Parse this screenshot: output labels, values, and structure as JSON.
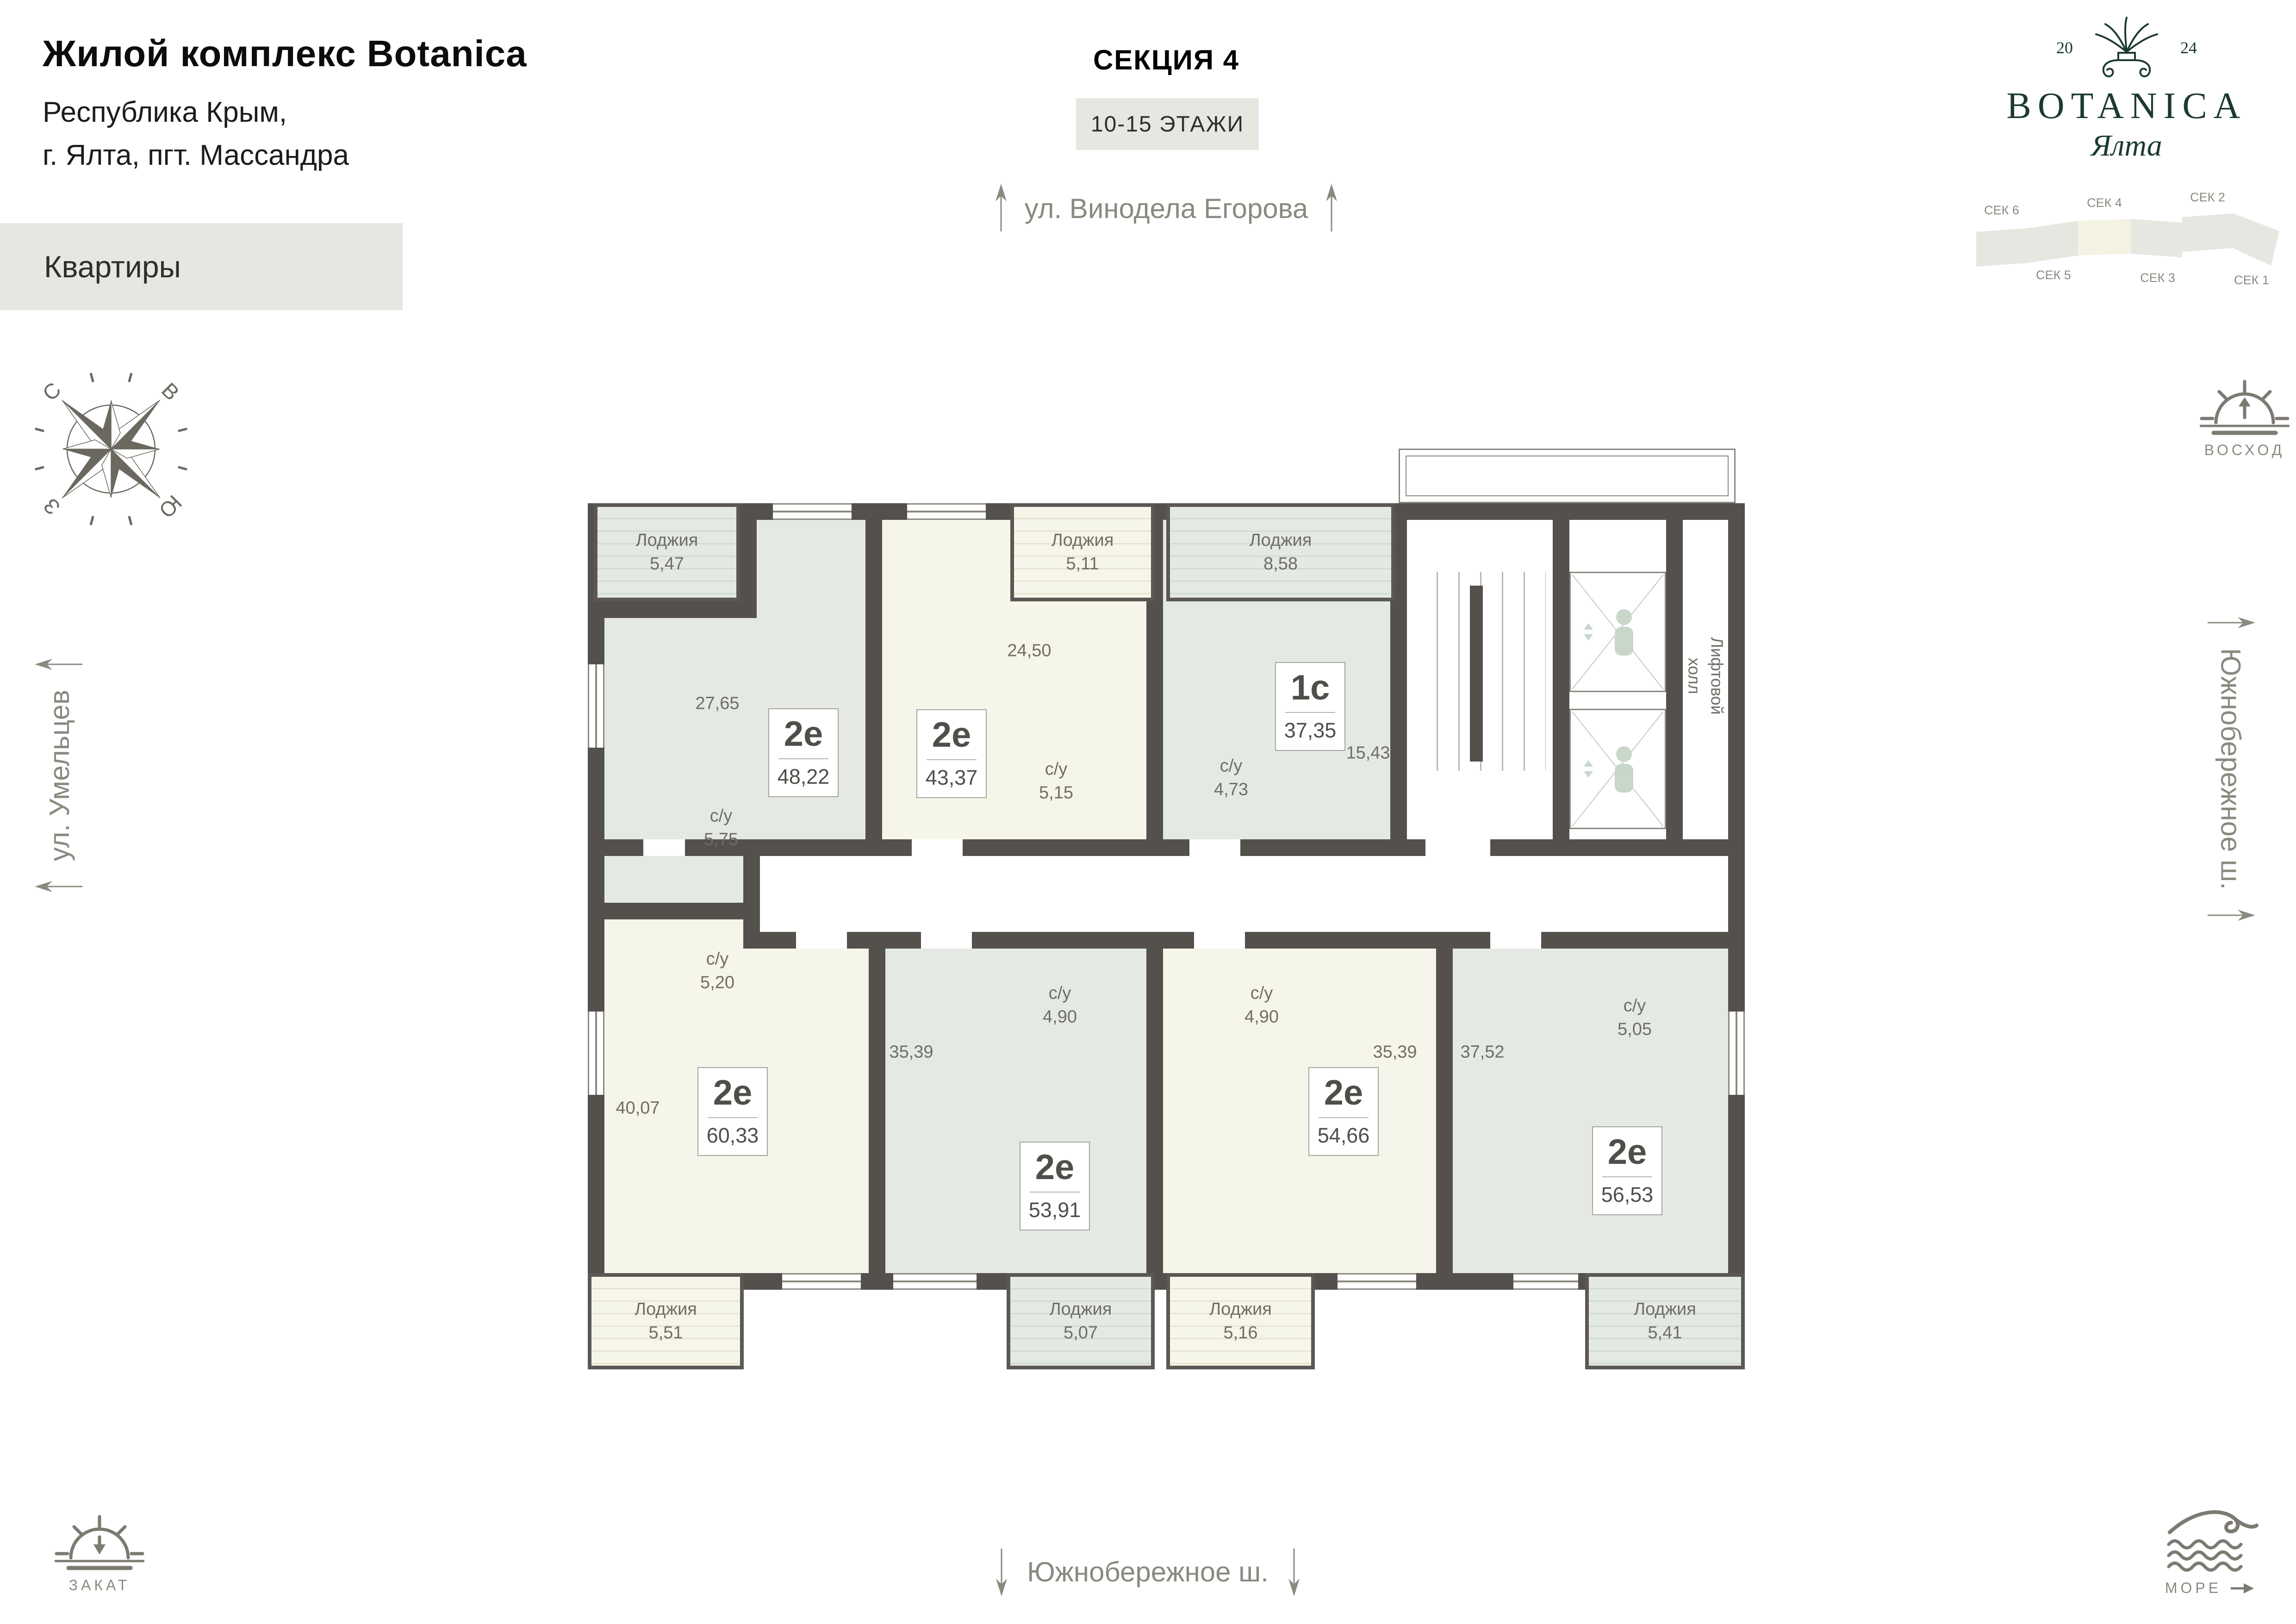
{
  "header": {
    "title": "Жилой комплекс Botanica",
    "address1": "Республика Крым,",
    "address2": "г. Ялта, пгт. Массандра",
    "category": "Квартиры"
  },
  "section": {
    "name": "СЕКЦИЯ 4",
    "floors": "10-15 ЭТАЖИ"
  },
  "streets": {
    "top": "ул. Винодела Егорова",
    "left": "ул. Умельцев",
    "right": "Южнобережное ш.",
    "bottom": "Южнобережное ш."
  },
  "logo": {
    "year_left": "20",
    "year_right": "24",
    "brand": "BOTANICA",
    "city": "Ялта"
  },
  "section_map": {
    "labels": [
      "СЕК 6",
      "СЕК 4",
      "СЕК 2",
      "СЕК 5",
      "СЕК 3",
      "СЕК 1"
    ],
    "highlight": "СЕК 4"
  },
  "compass": {
    "n": "С",
    "e": "В",
    "w": "З",
    "s": "Ю"
  },
  "landmarks": {
    "sunrise": "ВОСХОД",
    "sunset": "ЗАКАТ",
    "sea": "МОРЕ"
  },
  "colors": {
    "accent": "#1c3a31",
    "wall": "#54514d",
    "green_room": "#e4e9e3",
    "cream_room": "#f6f5e9",
    "highlight_box": "#e4e8e0"
  },
  "plan": {
    "lift1": "Лифтовой",
    "lift2": "холл",
    "apartments": [
      {
        "type": "2е",
        "area": "48,22"
      },
      {
        "type": "2е",
        "area": "43,37"
      },
      {
        "type": "1с",
        "area": "37,35"
      },
      {
        "type": "2е",
        "area": "60,33"
      },
      {
        "type": "2е",
        "area": "53,91"
      },
      {
        "type": "2е",
        "area": "54,66"
      },
      {
        "type": "2е",
        "area": "56,53"
      }
    ],
    "rooms": [
      "27,65",
      "24,50",
      "15,43",
      "40,07",
      "35,39",
      "35,39",
      "37,52"
    ],
    "wc_label": "с/у",
    "wc_areas": [
      "5,75",
      "5,15",
      "4,73",
      "5,20",
      "4,90",
      "4,90",
      "5,05"
    ],
    "loggia_label": "Лоджия",
    "loggia_areas": [
      "5,47",
      "5,11",
      "8,58",
      "5,51",
      "5,07",
      "5,16",
      "5,41"
    ]
  }
}
